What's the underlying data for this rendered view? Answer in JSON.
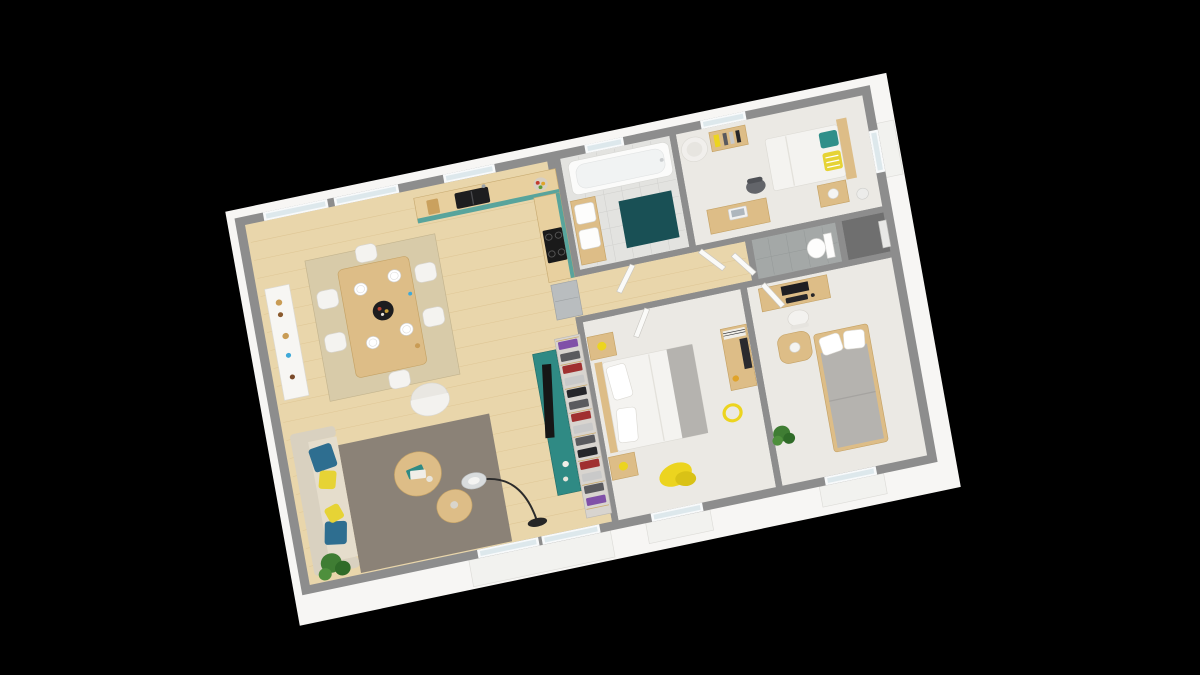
{
  "scene": {
    "kind": "3d-isometric-floor-plan-render",
    "background": "black",
    "rooms": [
      "open-living-dining-kitchen",
      "bathroom",
      "bedroom-top-right",
      "wc",
      "entry-alcove",
      "hallway",
      "bedroom-middle",
      "bedroom-bottom-right"
    ]
  },
  "colors": {
    "background": "#000000",
    "wall_top": "#8d8d8d",
    "wall_dark": "#6f6f6f",
    "exterior_white": "#f7f6f4",
    "floor_wood": "#e9d6ab",
    "floor_wood_line": "#d2b47c",
    "floor_carpet": "#ebe9e4",
    "floor_bath": "#e3e3e0",
    "floor_wc": "#a4a8a7",
    "kitchen_cabinet": "#58a49c",
    "counter_wood": "#e8d09f",
    "fridge_gray": "#b9bdbf",
    "bath_mat": "#195055",
    "tub_white": "#fbfbfa",
    "sofa_beige": "#d9d1c0",
    "sofa_seat": "#e5ddcc",
    "pillow_blue": "#2e6e90",
    "pillow_yellow": "#e6d335",
    "rug_gray": "#8b8277",
    "rug_jute": "#d8cba9",
    "accent_yellow": "#ecd41f",
    "wood_furniture": "#ddbd87",
    "bed_white": "#f4f3f0",
    "bed_gray": "#b5b3af",
    "console_teal": "#2f8a84",
    "tv_black": "#161616",
    "plant_green": "#3f7d33",
    "plant_green_dark": "#2f6b28",
    "door_white": "#fafaf8",
    "glass": "#dde8ec",
    "clothes": {
      "c1": "#a03030",
      "c2": "#5a5a5e",
      "c3": "#c9c9c9",
      "c4": "#8050a8",
      "c5": "#26262a"
    }
  }
}
